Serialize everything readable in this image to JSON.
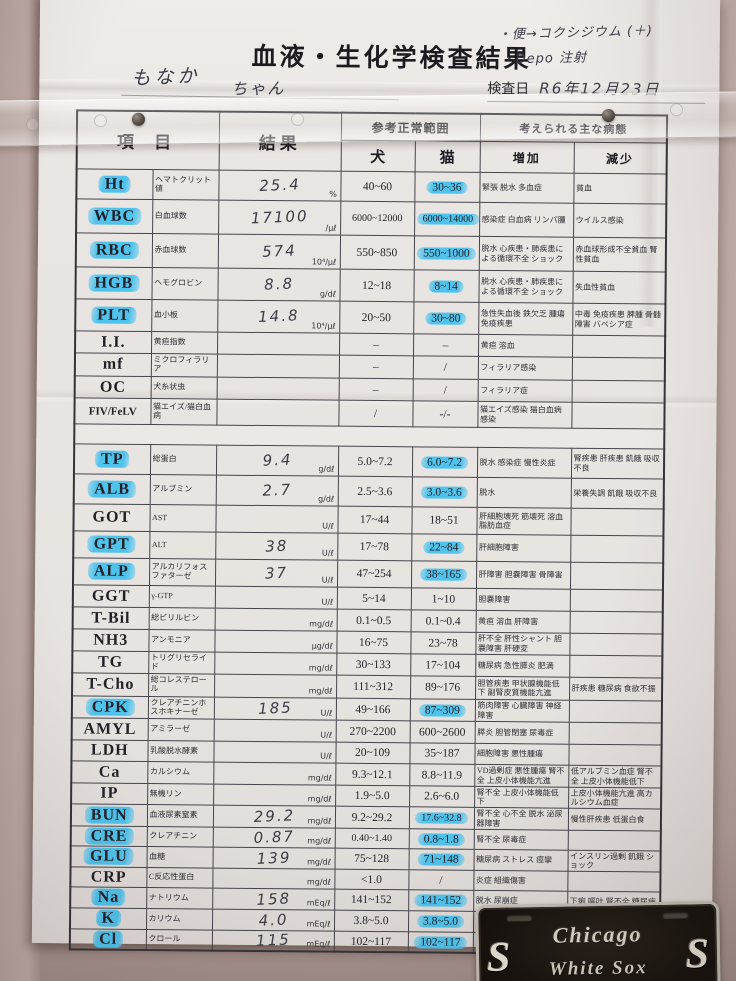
{
  "colors": {
    "highlight_marker": "#4fc3ec",
    "paper": "#e8e4e1",
    "wall": "#c3b0aa",
    "plate_background": "#16120e",
    "plate_trim": "#c3beb6"
  },
  "header": {
    "title": "血液・生化学検査結果",
    "pet_name": "もなか",
    "pet_suffix": "ちゃん",
    "notes": [
      "・便→コクシジウム (＋)",
      "・Depo 注射"
    ],
    "exam_date_label": "検査日",
    "exam_date_value": "R6年12月23日"
  },
  "table": {
    "headers": {
      "item": "項 目",
      "result": "結果",
      "ref_range": "参考正常範囲",
      "conditions": "考えられる主な病態",
      "dog": "犬",
      "cat": "猫",
      "increase": "増加",
      "decrease": "減少"
    },
    "sections": [
      {
        "rows": [
          {
            "code": "Ht",
            "code_hl": true,
            "name": "ヘマトクリット値",
            "result": "25.4",
            "unit": "%",
            "dog": "40~60",
            "cat": "30~36",
            "cat_hl": true,
            "inc": "緊張 脱水 多血症",
            "dec": "貧血"
          },
          {
            "code": "WBC",
            "code_hl": true,
            "name": "白血球数",
            "result": "17100",
            "unit": "/μℓ",
            "dog": "6000~12000",
            "cat": "6000~14000",
            "cat_hl": true,
            "inc": "感染症 白血病 リンパ腫",
            "dec": "ウイルス感染"
          },
          {
            "code": "RBC",
            "code_hl": true,
            "name": "赤血球数",
            "result": "574",
            "unit": "10⁴/μℓ",
            "dog": "550~850",
            "cat": "550~1000",
            "cat_hl": true,
            "inc": "脱水 心疾患・肺疾患による循環不全 ショック",
            "dec": "赤血球形成不全貧血 腎性貧血"
          },
          {
            "code": "HGB",
            "code_hl": true,
            "name": "ヘモグロビン",
            "result": "8.8",
            "unit": "g/dℓ",
            "dog": "12~18",
            "cat": "8~14",
            "cat_hl": true,
            "inc": "脱水 心疾患・肺疾患による循環不全 ショック",
            "dec": "失血性貧血"
          },
          {
            "code": "PLT",
            "code_hl": true,
            "name": "血小板",
            "result": "14.8",
            "unit": "10⁴/μℓ",
            "dog": "20~50",
            "cat": "30~80",
            "cat_hl": true,
            "inc": "急性失血後 鉄欠乏 腫瘍 免疫疾患",
            "dec": "中毒 免疫疾患 脾腫 骨髄障害 バベシア症"
          },
          {
            "code": "I.I.",
            "code_hl": false,
            "name": "黄疸指数",
            "result": "",
            "unit": "",
            "dog": "–",
            "cat": "–",
            "cat_hl": false,
            "inc": "黄疸 溶血",
            "dec": ""
          },
          {
            "code": "mf",
            "code_hl": false,
            "name": "ミクロフィラリア",
            "result": "",
            "unit": "",
            "dog": "–",
            "cat": "/",
            "cat_hl": false,
            "inc": "フィラリア感染",
            "dec": ""
          },
          {
            "code": "OC",
            "code_hl": false,
            "name": "犬糸状虫",
            "result": "",
            "unit": "",
            "dog": "–",
            "cat": "/",
            "cat_hl": false,
            "inc": "フィラリア症",
            "dec": ""
          },
          {
            "code": "FIV/FeLV",
            "code_hl": false,
            "name": "猫エイズ/猫白血病",
            "result": "",
            "unit": "",
            "dog": "/",
            "cat": "-/-",
            "cat_hl": false,
            "inc": "猫エイズ感染 猫白血病感染",
            "dec": ""
          }
        ]
      },
      {
        "rows": [
          {
            "code": "TP",
            "code_hl": true,
            "name": "総蛋白",
            "result": "9.4",
            "unit": "g/dℓ",
            "dog": "5.0~7.2",
            "cat": "6.0~7.2",
            "cat_hl": true,
            "inc": "脱水 感染症 慢性炎症",
            "dec": "腎疾患 肝疾患 飢餓 吸収不良"
          },
          {
            "code": "ALB",
            "code_hl": true,
            "name": "アルブミン",
            "result": "2.7",
            "unit": "g/dℓ",
            "dog": "2.5~3.6",
            "cat": "3.0~3.6",
            "cat_hl": true,
            "inc": "脱水",
            "dec": "栄養失調 飢餓 吸収不良"
          },
          {
            "code": "GOT",
            "code_hl": false,
            "name": "AST",
            "result": "",
            "unit": "U/ℓ",
            "dog": "17~44",
            "cat": "18~51",
            "cat_hl": false,
            "inc": "肝細胞壊死 筋壊死 溶血 脂肪血症",
            "dec": ""
          },
          {
            "code": "GPT",
            "code_hl": true,
            "name": "ALT",
            "result": "38",
            "unit": "U/ℓ",
            "dog": "17~78",
            "cat": "22~84",
            "cat_hl": true,
            "inc": "肝細胞障害",
            "dec": ""
          },
          {
            "code": "ALP",
            "code_hl": true,
            "name": "アルカリフォスファターゼ",
            "result": "37",
            "unit": "U/ℓ",
            "dog": "47~254",
            "cat": "38~165",
            "cat_hl": true,
            "inc": "肝障害 胆嚢障害 骨障害",
            "dec": ""
          },
          {
            "code": "GGT",
            "code_hl": false,
            "name": "γ-GTP",
            "result": "",
            "unit": "U/ℓ",
            "dog": "5~14",
            "cat": "1~10",
            "cat_hl": false,
            "inc": "胆嚢障害",
            "dec": ""
          },
          {
            "code": "T-Bil",
            "code_hl": false,
            "name": "総ビリルビン",
            "result": "",
            "unit": "mg/dℓ",
            "dog": "0.1~0.5",
            "cat": "0.1~0.4",
            "cat_hl": false,
            "inc": "黄疸 溶血 肝障害",
            "dec": ""
          },
          {
            "code": "NH3",
            "code_hl": false,
            "name": "アンモニア",
            "result": "",
            "unit": "μg/dℓ",
            "dog": "16~75",
            "cat": "23~78",
            "cat_hl": false,
            "inc": "肝不全 肝性シャント 胆嚢障害 肝硬変",
            "dec": ""
          },
          {
            "code": "TG",
            "code_hl": false,
            "name": "トリグリセライド",
            "result": "",
            "unit": "mg/dℓ",
            "dog": "30~133",
            "cat": "17~104",
            "cat_hl": false,
            "inc": "糖尿病 急性膵炎 肥満",
            "dec": ""
          },
          {
            "code": "T-Cho",
            "code_hl": false,
            "name": "総コレステロール",
            "result": "",
            "unit": "mg/dℓ",
            "dog": "111~312",
            "cat": "89~176",
            "cat_hl": false,
            "inc": "胆管疾患 甲状腺機能低下 副腎皮質機能亢進",
            "dec": "肝疾患 糖尿病 食欲不振"
          },
          {
            "code": "CPK",
            "code_hl": true,
            "name": "クレアチニンホスホキナーゼ",
            "result": "185",
            "unit": "U/ℓ",
            "dog": "49~166",
            "cat": "87~309",
            "cat_hl": true,
            "inc": "筋肉障害 心臓障害 神経障害",
            "dec": ""
          },
          {
            "code": "AMYL",
            "code_hl": false,
            "name": "アミラーゼ",
            "result": "",
            "unit": "U/ℓ",
            "dog": "270~2200",
            "cat": "600~2600",
            "cat_hl": false,
            "inc": "膵炎 胆管閉塞 尿毒症",
            "dec": ""
          },
          {
            "code": "LDH",
            "code_hl": false,
            "name": "乳酸脱水酵素",
            "result": "",
            "unit": "U/ℓ",
            "dog": "20~109",
            "cat": "35~187",
            "cat_hl": false,
            "inc": "細胞障害 悪性腫瘍",
            "dec": ""
          },
          {
            "code": "Ca",
            "code_hl": false,
            "name": "カルシウム",
            "result": "",
            "unit": "mg/dℓ",
            "dog": "9.3~12.1",
            "cat": "8.8~11.9",
            "cat_hl": false,
            "inc": "VD過剰症 悪性腫瘍 腎不全 上皮小体機能亢進",
            "dec": "低アルブミン血症 腎不全 上皮小体機能低下"
          },
          {
            "code": "IP",
            "code_hl": false,
            "name": "無機リン",
            "result": "",
            "unit": "mg/dℓ",
            "dog": "1.9~5.0",
            "cat": "2.6~6.0",
            "cat_hl": false,
            "inc": "腎不全 上皮小体機能低下",
            "dec": "上皮小体機能亢進 高カルシウム血症"
          },
          {
            "code": "BUN",
            "code_hl": true,
            "name": "血液尿素窒素",
            "result": "29.2",
            "unit": "mg/dℓ",
            "dog": "9.2~29.2",
            "cat": "17.6~32.8",
            "cat_hl": true,
            "inc": "腎不全 心不全 脱水 泌尿器障害",
            "dec": "慢性肝疾患 低蛋白食"
          },
          {
            "code": "CRE",
            "code_hl": true,
            "name": "クレアチニン",
            "result": "0.87",
            "unit": "mg/dℓ",
            "dog": "0.40~1.40",
            "cat": "0.8~1.8",
            "cat_hl": true,
            "inc": "腎不全 尿毒症",
            "dec": ""
          },
          {
            "code": "GLU",
            "code_hl": true,
            "name": "血糖",
            "result": "139",
            "unit": "mg/dℓ",
            "dog": "75~128",
            "cat": "71~148",
            "cat_hl": true,
            "inc": "糖尿病 ストレス 痙攣",
            "dec": "インスリン過剰 飢餓 ショック"
          },
          {
            "code": "CRP",
            "code_hl": false,
            "name": "C反応性蛋白",
            "result": "",
            "unit": "mg/dℓ",
            "dog": "<1.0",
            "cat": "/",
            "cat_hl": false,
            "inc": "炎症 組織傷害",
            "dec": ""
          },
          {
            "code": "Na",
            "code_hl": true,
            "name": "ナトリウム",
            "result": "158",
            "unit": "mEq/ℓ",
            "dog": "141~152",
            "cat": "141~152",
            "cat_hl": true,
            "inc": "脱水 尿崩症",
            "dec": "下痢 嘔吐 腎不全 糖尿病"
          },
          {
            "code": "K",
            "code_hl": true,
            "name": "カリウム",
            "result": "4.0",
            "unit": "mEq/ℓ",
            "dog": "3.8~5.0",
            "cat": "3.8~5.0",
            "cat_hl": true,
            "inc": "腎不全 脱水 溶血",
            "dec": "腎不全 多尿 下痢 嘔吐"
          },
          {
            "code": "Cl",
            "code_hl": true,
            "name": "クロール",
            "result": "115",
            "unit": "mEq/ℓ",
            "dog": "102~117",
            "cat": "102~117",
            "cat_hl": true,
            "inc": "脱水",
            "dec": "嘔吐"
          }
        ]
      }
    ]
  },
  "plate": {
    "city": "Chicago",
    "team": "White Sox",
    "logo_glyph": "S"
  }
}
